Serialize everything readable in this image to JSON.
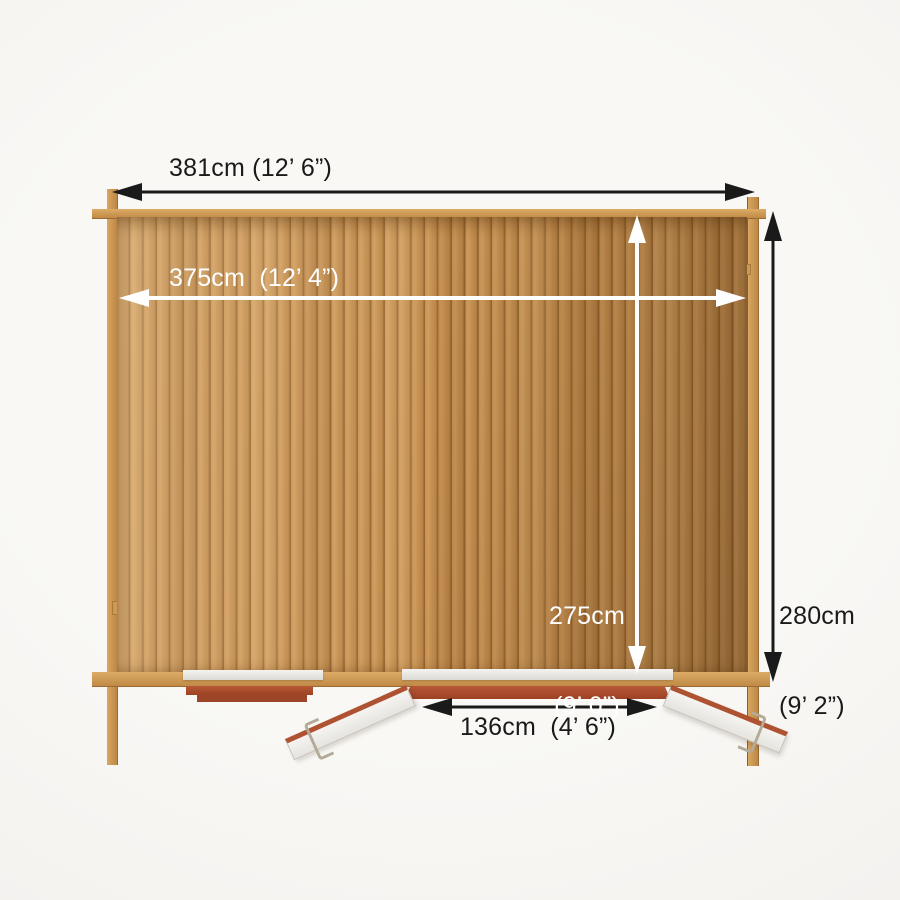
{
  "diagram": {
    "subject": "log cabin plan view with dimensions",
    "dimensions": {
      "outer_width": "381cm (12’ 6”)",
      "inner_width": "375cm  (12’ 4”)",
      "inner_depth_value": "275cm",
      "inner_depth_imperial": "(9’ 0”)",
      "outer_depth_value": "280cm",
      "outer_depth_imperial": "(9’ 2”)",
      "door_width": "136cm  (4’ 6”)"
    },
    "colors": {
      "background": "#f4f2ef",
      "wood_floor": "#c39052",
      "wood_log": "#cd9a55",
      "terracotta": "#ad5130",
      "door_white": "#f3f2ee",
      "dimension_black": "#1a1a1a",
      "dimension_white": "#ffffff"
    }
  }
}
